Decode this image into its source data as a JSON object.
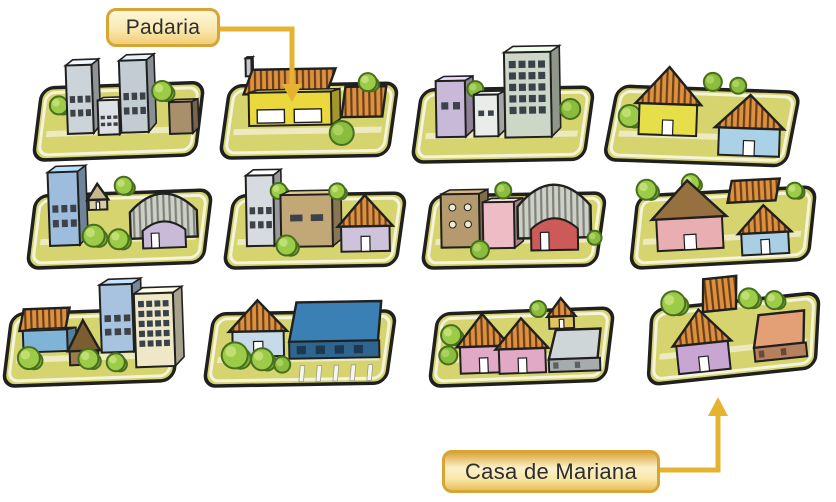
{
  "figure": {
    "type": "illustrated-neighborhood-map",
    "rows": 3,
    "cols": 4,
    "block_count": 12
  },
  "labels": {
    "padaria": "Padaria",
    "casa_de_mariana": "Casa de Mariana"
  },
  "callouts": [
    {
      "text_key": "padaria",
      "points_to": "padaria-block",
      "row": 1,
      "col": 2,
      "arrow_direction": "down"
    },
    {
      "text_key": "casa_de_mariana",
      "points_to": "casa-de-mariana-block",
      "row": 3,
      "col": 4,
      "arrow_direction": "up"
    }
  ],
  "palette": {
    "background": "#ffffff",
    "label_border": "#d8a435",
    "label_text": "#2e2e2e",
    "arrow": "#e5b32f",
    "ground": "#d6d46f",
    "ground_inner_line": "#f6f4e2",
    "outline": "#20201e",
    "roof_orange": "#dd9140",
    "roof_line": "#6b4018",
    "corrugated": "#ccd0c6",
    "corrugated_line": "#7e8278",
    "tree_fill": "#9ccb48",
    "tree_stroke": "#486f1e"
  },
  "blocks": [
    {
      "name": "city-block-1",
      "row": 1,
      "col": 1,
      "x": 42,
      "y": 88,
      "w": 162,
      "h": 72,
      "rot": -2,
      "items": [
        {
          "t": "tree",
          "cx": 0.1,
          "cy": 0.25,
          "r": 9
        },
        {
          "t": "tower",
          "x": 0.15,
          "y": -0.3,
          "w": 0.16,
          "h": 0.95,
          "wall": "#ccd3d9",
          "win": "rows"
        },
        {
          "t": "tower",
          "x": 0.34,
          "y": 0.2,
          "w": 0.13,
          "h": 0.48,
          "wall": "#dde1e4",
          "win": "rows"
        },
        {
          "t": "tower",
          "x": 0.48,
          "y": -0.34,
          "w": 0.17,
          "h": 1.0,
          "wall": "#c4ccd3",
          "win": "rows"
        },
        {
          "t": "tree",
          "cx": 0.74,
          "cy": 0.1,
          "r": 10
        },
        {
          "t": "tower",
          "x": 0.78,
          "y": 0.26,
          "w": 0.14,
          "h": 0.44,
          "wall": "#a9906c",
          "win": "none"
        }
      ]
    },
    {
      "name": "padaria-block",
      "row": 1,
      "col": 2,
      "x": 230,
      "y": 86,
      "w": 168,
      "h": 72,
      "rot": -1,
      "items": [
        {
          "t": "tower",
          "x": 0.095,
          "y": -0.38,
          "w": 0.035,
          "h": 0.25,
          "wall": "#c2c8cc",
          "win": "none"
        },
        {
          "t": "roof",
          "x": 0.08,
          "y": -0.22,
          "w": 0.55,
          "h": 0.34
        },
        {
          "t": "tower",
          "x": 0.11,
          "y": 0.1,
          "w": 0.49,
          "h": 0.46,
          "wall": "#ead83c",
          "win": "shop"
        },
        {
          "t": "roof",
          "x": 0.66,
          "y": 0.04,
          "w": 0.27,
          "h": 0.42
        },
        {
          "t": "tree",
          "cx": 0.82,
          "cy": -0.02,
          "r": 9
        },
        {
          "t": "bush",
          "cx": 0.66,
          "cy": 0.68,
          "r": 12
        }
      ]
    },
    {
      "name": "city-block-3",
      "row": 1,
      "col": 3,
      "x": 422,
      "y": 90,
      "w": 172,
      "h": 72,
      "rot": -1,
      "items": [
        {
          "t": "tower",
          "x": 0.08,
          "y": -0.12,
          "w": 0.17,
          "h": 0.78,
          "wall": "#c9b9d9",
          "win": "two"
        },
        {
          "t": "bush",
          "cx": 0.31,
          "cy": 0.0,
          "r": 8
        },
        {
          "t": "tower",
          "x": 0.3,
          "y": 0.08,
          "w": 0.14,
          "h": 0.58,
          "wall": "#e9ece9",
          "win": "two"
        },
        {
          "t": "tower",
          "x": 0.48,
          "y": -0.5,
          "w": 0.27,
          "h": 1.18,
          "wall": "#ccd7c7",
          "win": "grid"
        },
        {
          "t": "bush",
          "cx": 0.86,
          "cy": 0.3,
          "r": 10
        }
      ]
    },
    {
      "name": "city-block-4",
      "row": 1,
      "col": 4,
      "x": 618,
      "y": 86,
      "w": 182,
      "h": 74,
      "rot": 2,
      "items": [
        {
          "t": "tree",
          "cx": 0.07,
          "cy": 0.4,
          "r": 11
        },
        {
          "t": "house",
          "x": 0.1,
          "y": -0.28,
          "w": 0.36,
          "h": 0.92,
          "wall": "#e6df49"
        },
        {
          "t": "bush",
          "cx": 0.52,
          "cy": -0.1,
          "r": 9
        },
        {
          "t": "bush",
          "cx": 0.66,
          "cy": -0.06,
          "r": 8
        },
        {
          "t": "house",
          "x": 0.54,
          "y": 0.06,
          "w": 0.38,
          "h": 0.82,
          "wall": "#abd1e6"
        }
      ]
    },
    {
      "name": "city-block-5",
      "row": 2,
      "col": 1,
      "x": 36,
      "y": 196,
      "w": 176,
      "h": 72,
      "rot": -2,
      "items": [
        {
          "t": "tower",
          "x": 0.07,
          "y": -0.32,
          "w": 0.17,
          "h": 1.02,
          "wall": "#9dbddd",
          "win": "rows"
        },
        {
          "t": "house",
          "x": 0.29,
          "y": -0.14,
          "w": 0.12,
          "h": 0.36,
          "wall": "#d9cba6",
          "plain": true,
          "roofColor": "#c9b68c"
        },
        {
          "t": "tree",
          "cx": 0.5,
          "cy": -0.1,
          "r": 9
        },
        {
          "t": "hangar",
          "x": 0.53,
          "y": 0.0,
          "w": 0.38,
          "h": 0.78,
          "wall": "#c9bad7"
        },
        {
          "t": "tree",
          "cx": 0.32,
          "cy": 0.58,
          "r": 11
        },
        {
          "t": "tree",
          "cx": 0.46,
          "cy": 0.64,
          "r": 10
        }
      ]
    },
    {
      "name": "city-block-6",
      "row": 2,
      "col": 2,
      "x": 234,
      "y": 196,
      "w": 172,
      "h": 72,
      "rot": -1,
      "items": [
        {
          "t": "tower",
          "x": 0.07,
          "y": -0.28,
          "w": 0.16,
          "h": 0.98,
          "wall": "#d7dade",
          "win": "rows"
        },
        {
          "t": "tree",
          "cx": 0.26,
          "cy": -0.06,
          "r": 8
        },
        {
          "t": "tower",
          "x": 0.27,
          "y": 0.0,
          "w": 0.3,
          "h": 0.72,
          "wall": "#c2a877",
          "win": "two"
        },
        {
          "t": "tree",
          "cx": 0.6,
          "cy": -0.04,
          "r": 8
        },
        {
          "t": "house",
          "x": 0.6,
          "y": 0.02,
          "w": 0.32,
          "h": 0.78,
          "wall": "#cfc3dc"
        },
        {
          "t": "tree",
          "cx": 0.3,
          "cy": 0.7,
          "r": 10
        }
      ]
    },
    {
      "name": "city-block-7",
      "row": 2,
      "col": 3,
      "x": 432,
      "y": 196,
      "w": 174,
      "h": 72,
      "rot": -1,
      "items": [
        {
          "t": "tower",
          "x": 0.05,
          "y": -0.02,
          "w": 0.22,
          "h": 0.74,
          "wall": "#b59a6d",
          "win": "dots"
        },
        {
          "t": "tower",
          "x": 0.29,
          "y": 0.1,
          "w": 0.18,
          "h": 0.64,
          "wall": "#eebcc4",
          "win": "none"
        },
        {
          "t": "bush",
          "cx": 0.41,
          "cy": -0.06,
          "r": 8
        },
        {
          "t": "hangar",
          "x": 0.49,
          "y": -0.16,
          "w": 0.42,
          "h": 0.94,
          "wall": "#cb5a58"
        },
        {
          "t": "bush",
          "cx": 0.27,
          "cy": 0.76,
          "r": 9
        },
        {
          "t": "bush",
          "cx": 0.93,
          "cy": 0.62,
          "r": 7
        }
      ]
    },
    {
      "name": "city-block-8",
      "row": 2,
      "col": 4,
      "x": 638,
      "y": 196,
      "w": 178,
      "h": 72,
      "rot": -3,
      "items": [
        {
          "t": "tree",
          "cx": 0.05,
          "cy": -0.08,
          "r": 10
        },
        {
          "t": "tree",
          "cx": 0.3,
          "cy": -0.14,
          "r": 9
        },
        {
          "t": "house",
          "x": 0.07,
          "y": -0.18,
          "w": 0.42,
          "h": 0.96,
          "wall": "#e9aeb2",
          "plain": true,
          "roofColor": "#96703f"
        },
        {
          "t": "roof",
          "x": 0.5,
          "y": -0.14,
          "w": 0.3,
          "h": 0.3
        },
        {
          "t": "tree",
          "cx": 0.88,
          "cy": 0.04,
          "r": 8
        },
        {
          "t": "house",
          "x": 0.55,
          "y": 0.22,
          "w": 0.3,
          "h": 0.68,
          "wall": "#a9cfe4"
        }
      ]
    },
    {
      "name": "city-block-9",
      "row": 3,
      "col": 1,
      "x": 12,
      "y": 314,
      "w": 170,
      "h": 72,
      "rot": -2,
      "items": [
        {
          "t": "roof",
          "x": 0.04,
          "y": -0.06,
          "w": 0.3,
          "h": 0.3
        },
        {
          "t": "tower",
          "x": 0.06,
          "y": 0.24,
          "w": 0.26,
          "h": 0.3,
          "wall": "#7fb4d8",
          "win": "none"
        },
        {
          "t": "house",
          "x": 0.32,
          "y": 0.12,
          "w": 0.19,
          "h": 0.62,
          "wall": "#9a7b4f",
          "roofH": 0.62,
          "plain": true,
          "roofColor": "#7d5c31"
        },
        {
          "t": "tower",
          "x": 0.52,
          "y": -0.36,
          "w": 0.19,
          "h": 0.94,
          "wall": "#a8c3df",
          "win": "rows"
        },
        {
          "t": "tower",
          "x": 0.72,
          "y": -0.22,
          "w": 0.23,
          "h": 1.02,
          "wall": "#efe8c6",
          "win": "grid"
        },
        {
          "t": "tree",
          "cx": 0.09,
          "cy": 0.62,
          "r": 11
        },
        {
          "t": "tree",
          "cx": 0.44,
          "cy": 0.66,
          "r": 10
        },
        {
          "t": "tree",
          "cx": 0.6,
          "cy": 0.72,
          "r": 9
        }
      ]
    },
    {
      "name": "city-block-10",
      "row": 3,
      "col": 2,
      "x": 214,
      "y": 314,
      "w": 182,
      "h": 72,
      "rot": -1,
      "items": [
        {
          "t": "house",
          "x": 0.08,
          "y": -0.18,
          "w": 0.32,
          "h": 0.78,
          "wall": "#c6dae8"
        },
        {
          "t": "box",
          "x": 0.41,
          "y": -0.14,
          "w": 0.51,
          "h": 0.78,
          "top": "#3b80b4",
          "doors": 4
        },
        {
          "t": "stripes",
          "x": 0.5,
          "y": 0.74,
          "w": 0.42,
          "h": 0.22,
          "n": 5
        },
        {
          "t": "tree",
          "cx": 0.11,
          "cy": 0.58,
          "r": 13
        },
        {
          "t": "tree",
          "cx": 0.26,
          "cy": 0.64,
          "r": 11
        },
        {
          "t": "bush",
          "cx": 0.37,
          "cy": 0.72,
          "r": 8
        }
      ]
    },
    {
      "name": "city-block-11",
      "row": 3,
      "col": 3,
      "x": 438,
      "y": 314,
      "w": 176,
      "h": 72,
      "rot": -2,
      "items": [
        {
          "t": "tree",
          "cx": 0.07,
          "cy": 0.3,
          "r": 10
        },
        {
          "t": "bush",
          "cx": 0.05,
          "cy": 0.58,
          "r": 9
        },
        {
          "t": "house",
          "x": 0.1,
          "y": 0.02,
          "w": 0.3,
          "h": 0.82,
          "wall": "#e2a9c6"
        },
        {
          "t": "house",
          "x": 0.32,
          "y": 0.1,
          "w": 0.3,
          "h": 0.76,
          "wall": "#e2a9c6"
        },
        {
          "t": "house",
          "x": 0.62,
          "y": -0.16,
          "w": 0.16,
          "h": 0.42,
          "wall": "#e0c45c"
        },
        {
          "t": "bush",
          "cx": 0.57,
          "cy": -0.02,
          "r": 8
        },
        {
          "t": "box",
          "x": 0.62,
          "y": 0.28,
          "w": 0.3,
          "h": 0.58,
          "top": "#cfd6d8",
          "doors": 2
        }
      ]
    },
    {
      "name": "casa-de-mariana-block",
      "row": 3,
      "col": 4,
      "x": 652,
      "y": 310,
      "w": 168,
      "h": 74,
      "rot": -6,
      "items": [
        {
          "t": "tree",
          "cx": 0.13,
          "cy": -0.06,
          "r": 12
        },
        {
          "t": "roof",
          "x": 0.3,
          "y": -0.34,
          "w": 0.22,
          "h": 0.44
        },
        {
          "t": "house",
          "x": 0.1,
          "y": 0.06,
          "w": 0.35,
          "h": 0.84,
          "wall": "#c7a6d3"
        },
        {
          "t": "tree",
          "cx": 0.58,
          "cy": -0.02,
          "r": 10
        },
        {
          "t": "tree",
          "cx": 0.73,
          "cy": 0.04,
          "r": 9
        },
        {
          "t": "box",
          "x": 0.58,
          "y": 0.22,
          "w": 0.32,
          "h": 0.62,
          "top": "#e3a076",
          "doors": 2
        }
      ]
    }
  ]
}
